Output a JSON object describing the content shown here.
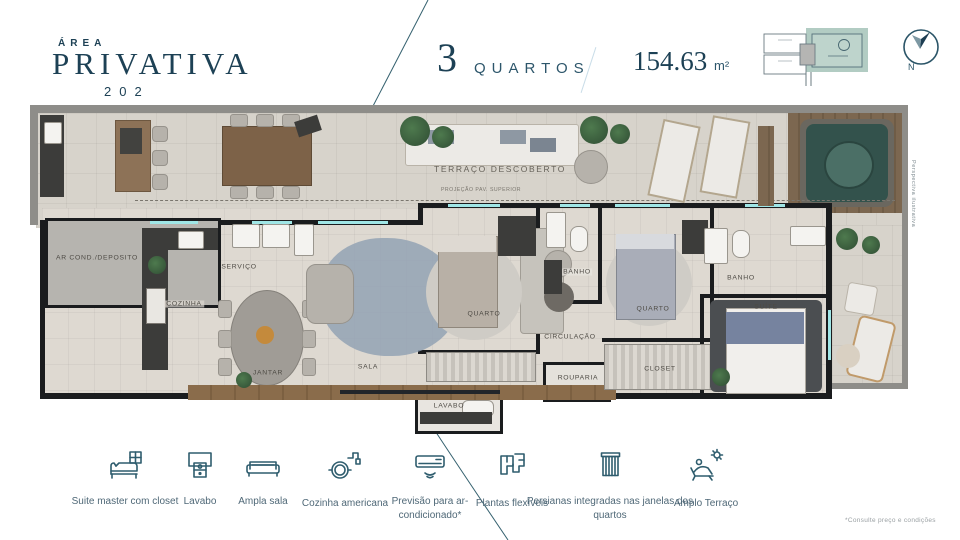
{
  "header": {
    "area_label": "ÁREA",
    "title": "PRIVATIVA",
    "unit_number": "202",
    "bedrooms_number": "3",
    "bedrooms_label": "QUARTOS",
    "area_value": "154.63",
    "area_unit": "m²",
    "compass_label": "N"
  },
  "plan": {
    "projection_label": "PROJEÇÃO PAV. SUPERIOR",
    "watermark": "Perspectiva ilustrativa",
    "rooms": [
      {
        "label": "TERRAÇO DESCOBERTO"
      },
      {
        "label": "AR COND./DEPOSITO"
      },
      {
        "label": "SERVIÇO"
      },
      {
        "label": "COZINHA"
      },
      {
        "label": "JANTAR"
      },
      {
        "label": "SALA"
      },
      {
        "label": "QUARTO"
      },
      {
        "label": "BANHO"
      },
      {
        "label": "QUARTO"
      },
      {
        "label": "BANHO"
      },
      {
        "label": "SUÍTE"
      },
      {
        "label": "CIRCULAÇÃO"
      },
      {
        "label": "ROUPARIA"
      },
      {
        "label": "CLOSET"
      },
      {
        "label": "LAVABO"
      }
    ]
  },
  "features": [
    {
      "icon": "bed-closet-icon",
      "label": "Suite master com closet"
    },
    {
      "icon": "vanity-icon",
      "label": "Lavabo"
    },
    {
      "icon": "sofa-icon",
      "label": "Ampla sala"
    },
    {
      "icon": "pot-faucet-icon",
      "label": "Cozinha americana"
    },
    {
      "icon": "air-conditioner-icon",
      "label": "Previsão para ar-condicionado*"
    },
    {
      "icon": "flexible-plans-icon",
      "label": "Plantas flexíveis"
    },
    {
      "icon": "blinds-icon",
      "label": "Persianas integradas nas janelas dos quartos"
    },
    {
      "icon": "sun-lounger-icon",
      "label": "Amplo Terraço"
    }
  ],
  "footnote": "*Consulte preço e condições"
}
